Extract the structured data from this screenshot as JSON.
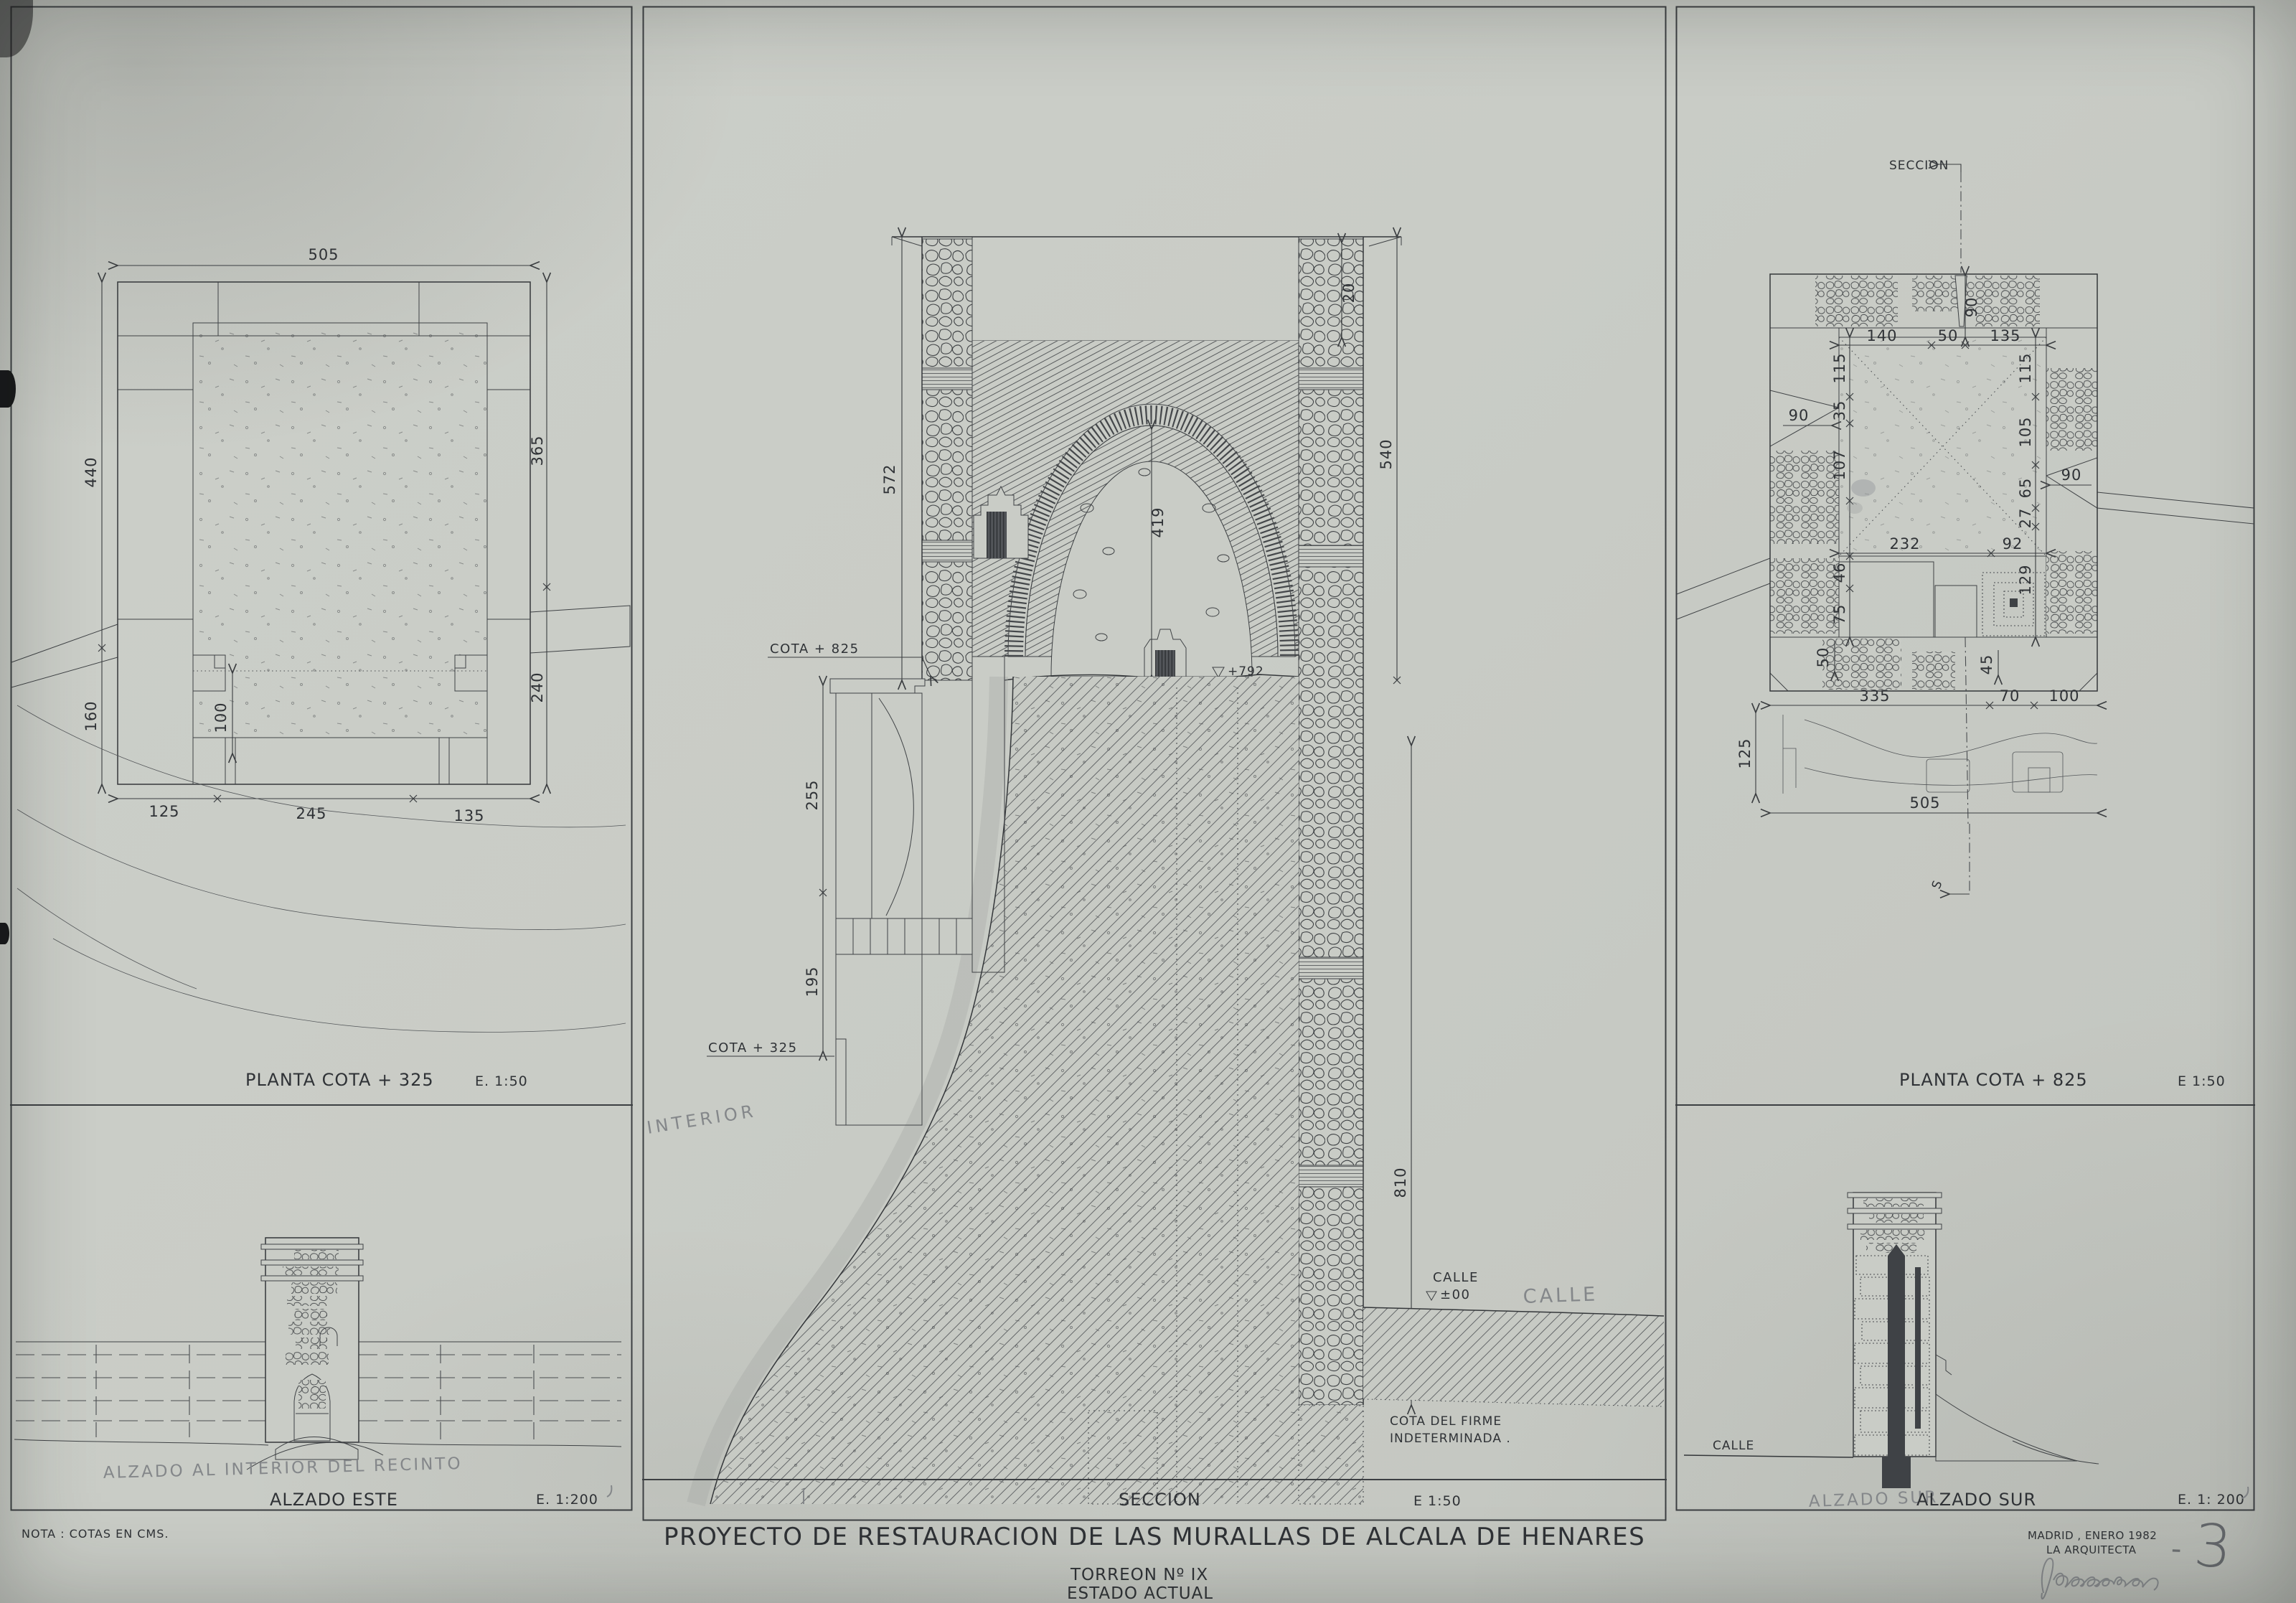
{
  "colors": {
    "paper": "#c9ccc6",
    "ink": "#34373a",
    "pencil": "#84878a"
  },
  "sheet": {
    "note": "NOTA : COTAS EN CMS.",
    "title": "PROYECTO DE RESTAURACION DE LAS MURALLAS DE ALCALA DE HENARES",
    "subtitle": "TORREON Nº IX",
    "state": "ESTADO ACTUAL",
    "place_date": "MADRID , ENERO 1982",
    "author": "LA ARQUITECTA",
    "sheet_no_dash": "-",
    "sheet_no": "3"
  },
  "plan325": {
    "title": "PLANTA COTA + 325",
    "scale": "E. 1:50",
    "dims": {
      "top": "505",
      "left": "440",
      "left_lower": "160",
      "right": "365",
      "right_lower": "240",
      "inner": "100",
      "b1": "125",
      "b2": "245",
      "b3": "135"
    }
  },
  "alzadoEste": {
    "pencil_note": "ALZADO AL INTERIOR DEL RECINTO",
    "title": "ALZADO ESTE",
    "scale": "E. 1:200"
  },
  "seccion": {
    "title": "SECCION",
    "scale": "E 1:50",
    "cota_825": "COTA + 825",
    "cota_325": "COTA + 325",
    "nivel_interior": "+792",
    "calle": "CALLE",
    "nivel_calle": "±00",
    "calle_pencil": "CALLE",
    "firme_1": "COTA DEL FIRME",
    "firme_2": "INDETERMINADA .",
    "interior_pencil": "INTERIOR",
    "dims": {
      "left": "572",
      "right": "540",
      "axis": "419",
      "top": "20",
      "ret_upper": "255",
      "ret_lower": "195",
      "right_lower": "810"
    }
  },
  "plan825": {
    "title": "PLANTA COTA + 825",
    "scale": "E 1:50",
    "section_label": "SECCION",
    "section_end": "S",
    "dims": {
      "top_offset": "90",
      "t1": "140",
      "t2": "50",
      "t3": "135",
      "l1": "115",
      "l2": "35",
      "l3": "107",
      "l4": "46",
      "l5": "75",
      "l_emb": "90",
      "r1": "115",
      "r2": "105",
      "r3": "65",
      "r4": "27",
      "r5": "129",
      "r_emb": "90",
      "m1": "232",
      "m2": "92",
      "stair": "50",
      "spiral": "45",
      "b1": "335",
      "b2": "70",
      "b3": "100",
      "terrain": "125",
      "total": "505"
    }
  },
  "alzadoSur": {
    "pencil_note": "ALZADO SUR",
    "title": "ALZADO SUR",
    "scale": "E. 1: 200",
    "calle": "CALLE"
  }
}
